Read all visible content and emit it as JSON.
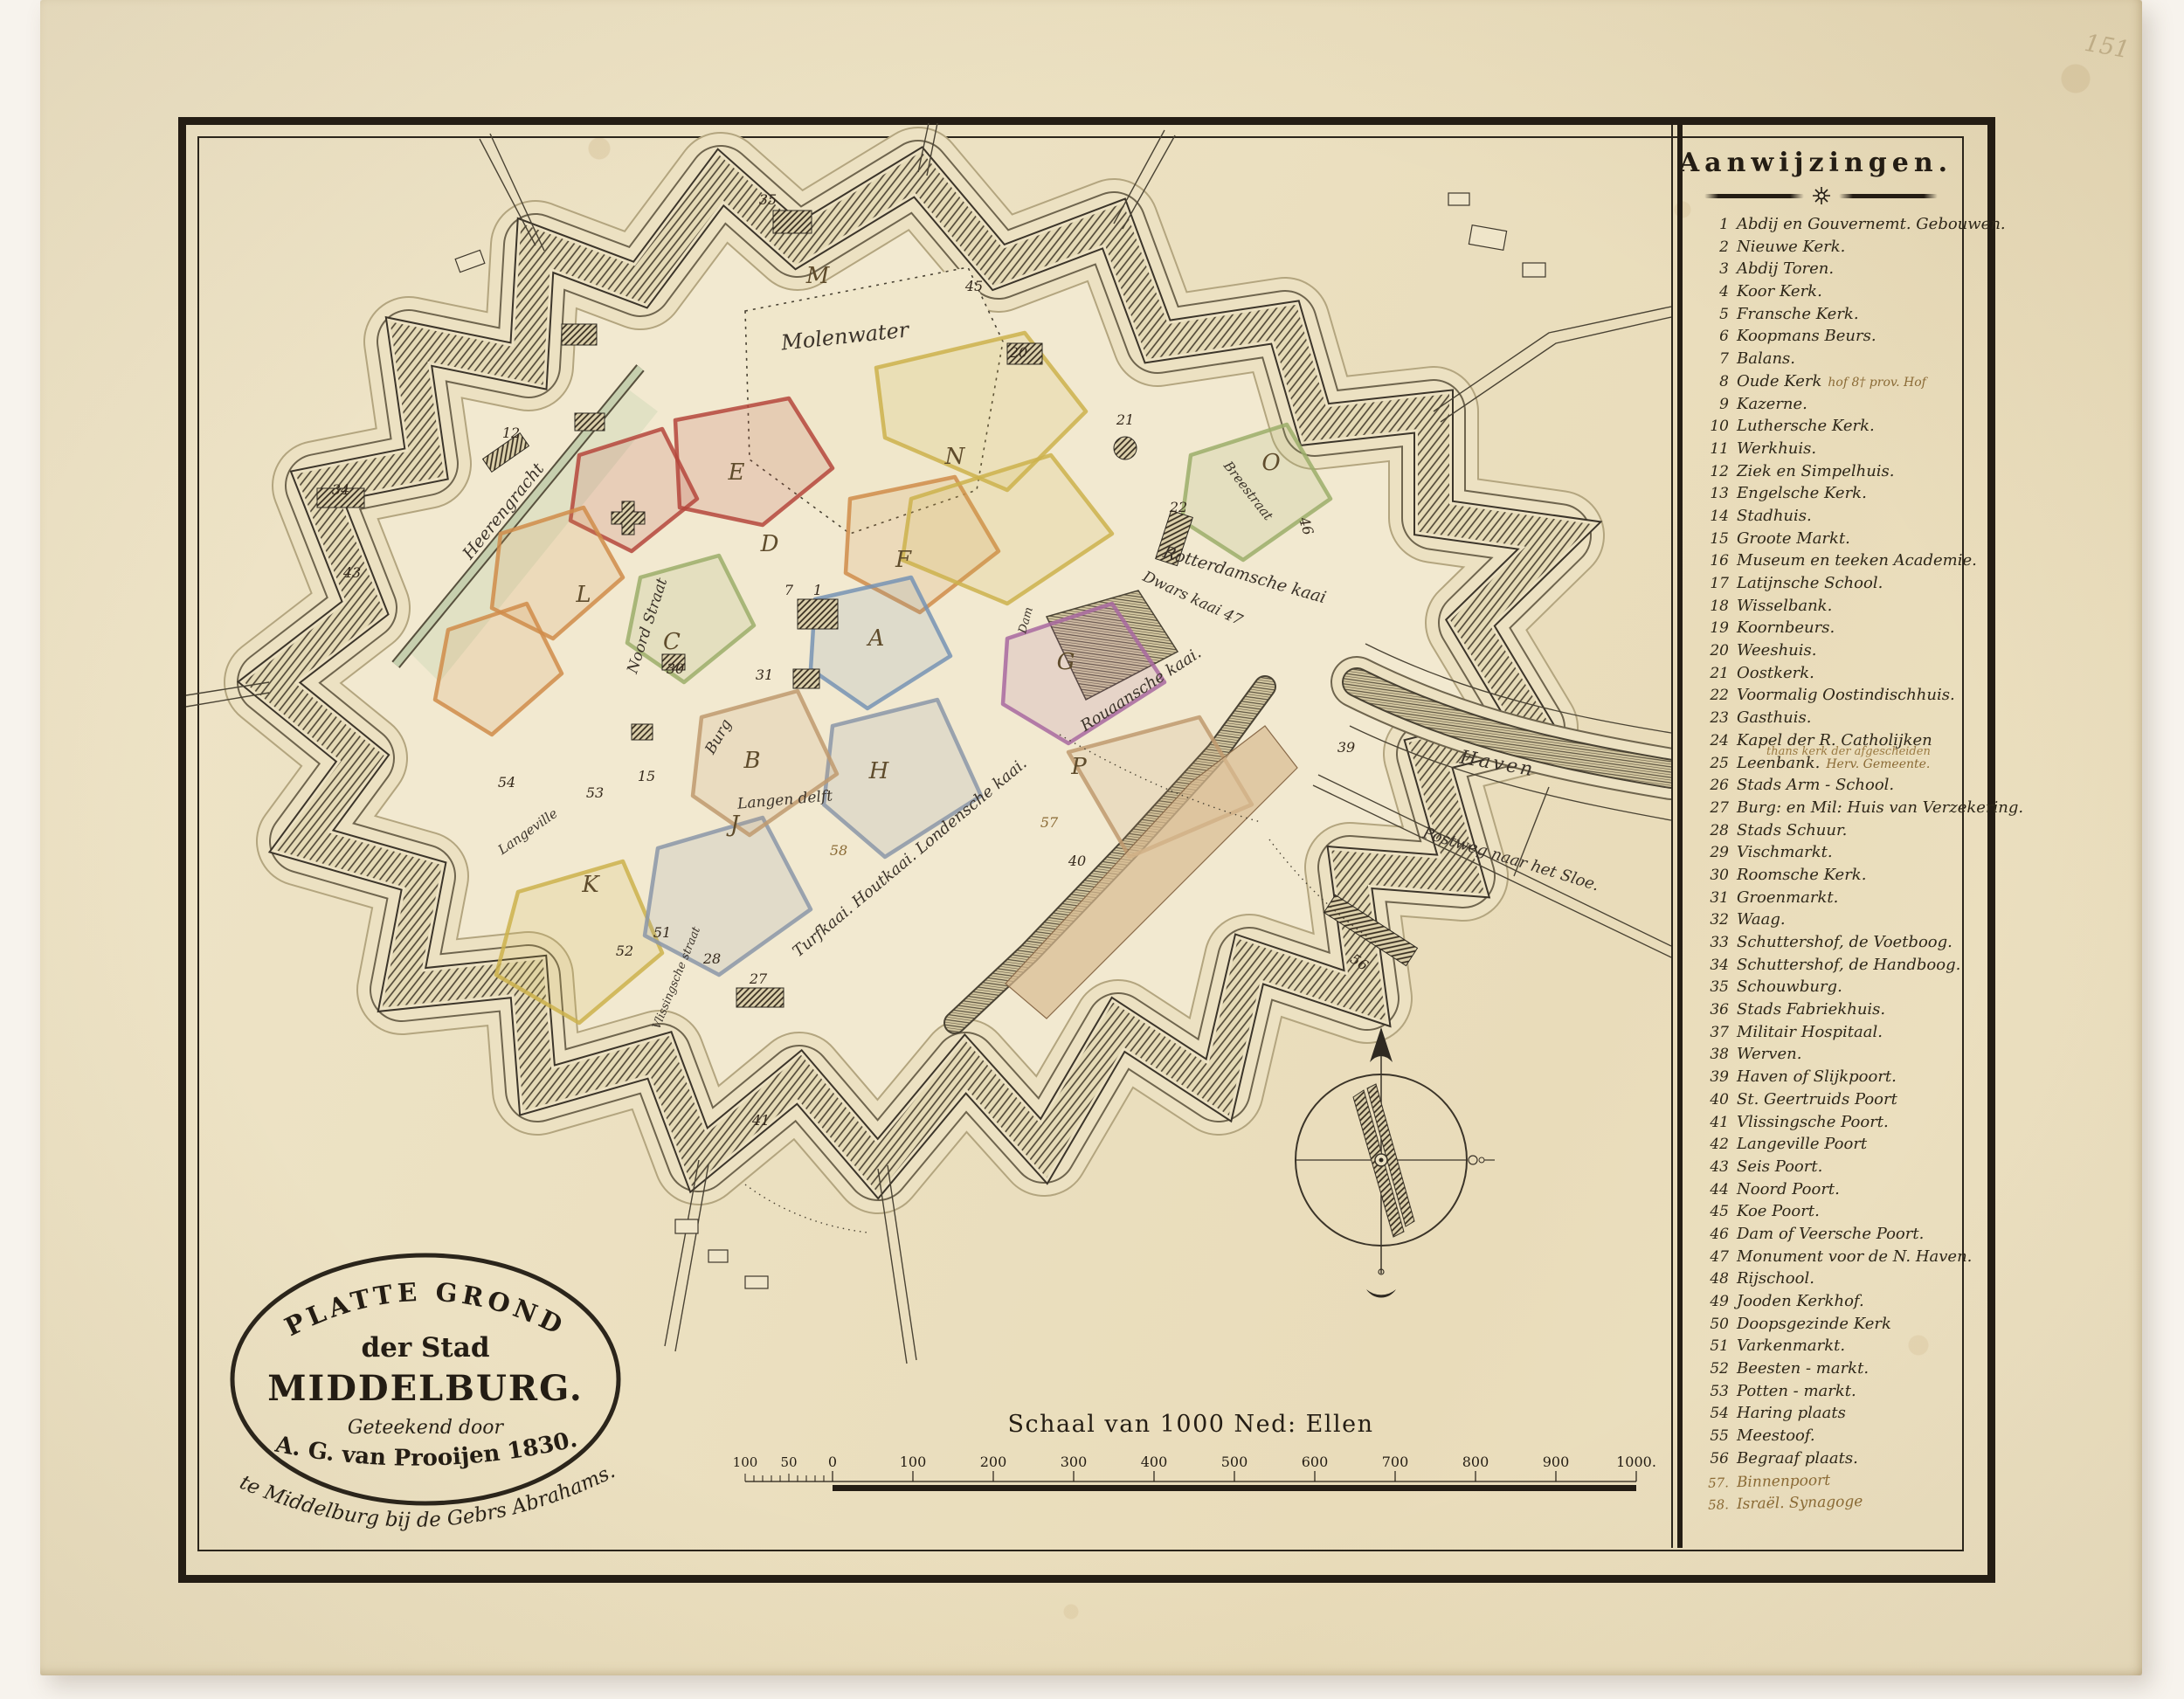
{
  "corner_mark": "151",
  "cartouche": {
    "line1": "PLATTE GROND",
    "line2": "der Stad",
    "line3": "MIDDELBURG.",
    "line4": "Geteekend door",
    "line5": "A. G. van Prooijen 1830.",
    "publisher": "te Middelburg bij de Gebrs Abrahams."
  },
  "scalebar": {
    "title": "Schaal van 1000 Ned: Ellen",
    "pre_labels": [
      "100",
      "50"
    ],
    "labels": [
      "0",
      "100",
      "200",
      "300",
      "400",
      "500",
      "600",
      "700",
      "800",
      "900",
      "1000."
    ]
  },
  "legend": {
    "title": "Aanwijzingen.",
    "items": [
      {
        "num": "1",
        "label": "Abdij en Gouvernemt. Gebouwen."
      },
      {
        "num": "2",
        "label": "Nieuwe Kerk."
      },
      {
        "num": "3",
        "label": "Abdij Toren."
      },
      {
        "num": "4",
        "label": "Koor Kerk."
      },
      {
        "num": "5",
        "label": "Fransche Kerk."
      },
      {
        "num": "6",
        "label": "Koopmans Beurs."
      },
      {
        "num": "7",
        "label": "Balans."
      },
      {
        "num": "8",
        "label": "Oude Kerk",
        "annotation": "hof  8† prov. Hof"
      },
      {
        "num": "9",
        "label": "Kazerne."
      },
      {
        "num": "10",
        "label": "Luthersche Kerk."
      },
      {
        "num": "11",
        "label": "Werkhuis."
      },
      {
        "num": "12",
        "label": "Ziek en Simpelhuis."
      },
      {
        "num": "13",
        "label": "Engelsche Kerk."
      },
      {
        "num": "14",
        "label": "Stadhuis."
      },
      {
        "num": "15",
        "label": "Groote Markt."
      },
      {
        "num": "16",
        "label": "Museum en teeken Academie."
      },
      {
        "num": "17",
        "label": "Latijnsche School."
      },
      {
        "num": "18",
        "label": "Wisselbank."
      },
      {
        "num": "19",
        "label": "Koornbeurs."
      },
      {
        "num": "20",
        "label": "Weeshuis."
      },
      {
        "num": "21",
        "label": "Oostkerk."
      },
      {
        "num": "22",
        "label": "Voormalig Oostindischhuis."
      },
      {
        "num": "23",
        "label": "Gasthuis."
      },
      {
        "num": "24",
        "label": "Kapel der R. Catholijken",
        "annotation_below": "thans kerk der afgescheiden"
      },
      {
        "num": "25",
        "label": "Leenbank.",
        "annotation": "Herv. Gemeente."
      },
      {
        "num": "26",
        "label": "Stads Arm - School."
      },
      {
        "num": "27",
        "label": "Burg: en Mil: Huis van Verzekering."
      },
      {
        "num": "28",
        "label": "Stads Schuur."
      },
      {
        "num": "29",
        "label": "Vischmarkt."
      },
      {
        "num": "30",
        "label": "Roomsche Kerk."
      },
      {
        "num": "31",
        "label": "Groenmarkt."
      },
      {
        "num": "32",
        "label": "Waag."
      },
      {
        "num": "33",
        "label": "Schuttershof, de Voetboog."
      },
      {
        "num": "34",
        "label": "Schuttershof, de Handboog."
      },
      {
        "num": "35",
        "label": "Schouwburg."
      },
      {
        "num": "36",
        "label": "Stads Fabriekhuis."
      },
      {
        "num": "37",
        "label": "Militair Hospitaal."
      },
      {
        "num": "38",
        "label": "Werven."
      },
      {
        "num": "39",
        "label": "Haven of Slijkpoort."
      },
      {
        "num": "40",
        "label": "St. Geertruids Poort"
      },
      {
        "num": "41",
        "label": "Vlissingsche Poort."
      },
      {
        "num": "42",
        "label": "Langeville Poort"
      },
      {
        "num": "43",
        "label": "Seis Poort."
      },
      {
        "num": "44",
        "label": "Noord Poort."
      },
      {
        "num": "45",
        "label": "Koe Poort."
      },
      {
        "num": "46",
        "label": "Dam of Veersche Poort."
      },
      {
        "num": "47",
        "label": "Monument voor de N. Haven."
      },
      {
        "num": "48",
        "label": "Rijschool."
      },
      {
        "num": "49",
        "label": "Jooden Kerkhof."
      },
      {
        "num": "50",
        "label": "Doopsgezinde Kerk"
      },
      {
        "num": "51",
        "label": "Varkenmarkt."
      },
      {
        "num": "52",
        "label": "Beesten - markt."
      },
      {
        "num": "53",
        "label": "Potten - markt."
      },
      {
        "num": "54",
        "label": "Haring plaats"
      },
      {
        "num": "55",
        "label": "Meestoof."
      },
      {
        "num": "56",
        "label": "Begraaf plaats."
      },
      {
        "num": "57.",
        "label": "Binnenpoort",
        "handwritten": true
      },
      {
        "num": "58.",
        "label": "Israël. Synagoge",
        "handwritten": true
      }
    ]
  },
  "map": {
    "labels": {
      "molenwater": "Molenwater",
      "heerengracht": "Heerengracht",
      "noordstraat": "Noord Straat",
      "burg": "Burg",
      "langedelft": "Langen delft",
      "kaaien": "Turfkaai. Houtkaai. Londensche kaai.",
      "rouaanschekaai": "Rouaansche kaai.",
      "rotterdamschekaai": "Rotterdamsche kaai",
      "dwarskaai": "Dwars kaai 47",
      "breestraat": "Breestraat",
      "haven": "Haven",
      "postweg": "Postweg naar het Sloe.",
      "langeville": "Langeville",
      "vlissingschestraat": "Vlissingsche straat",
      "dam": "Dam"
    },
    "letters": [
      "M",
      "N",
      "O",
      "C",
      "D",
      "E",
      "F",
      "A",
      "B",
      "H",
      "J",
      "K",
      "L",
      "P",
      "G"
    ],
    "numbers": [
      "45",
      "20",
      "21",
      "22",
      "7",
      "31",
      "51",
      "15",
      "53",
      "54",
      "34",
      "12",
      "39",
      "40",
      "41",
      "56",
      "57",
      "58",
      "52",
      "27",
      "28",
      "43",
      "46",
      "30",
      "1",
      "35"
    ]
  }
}
